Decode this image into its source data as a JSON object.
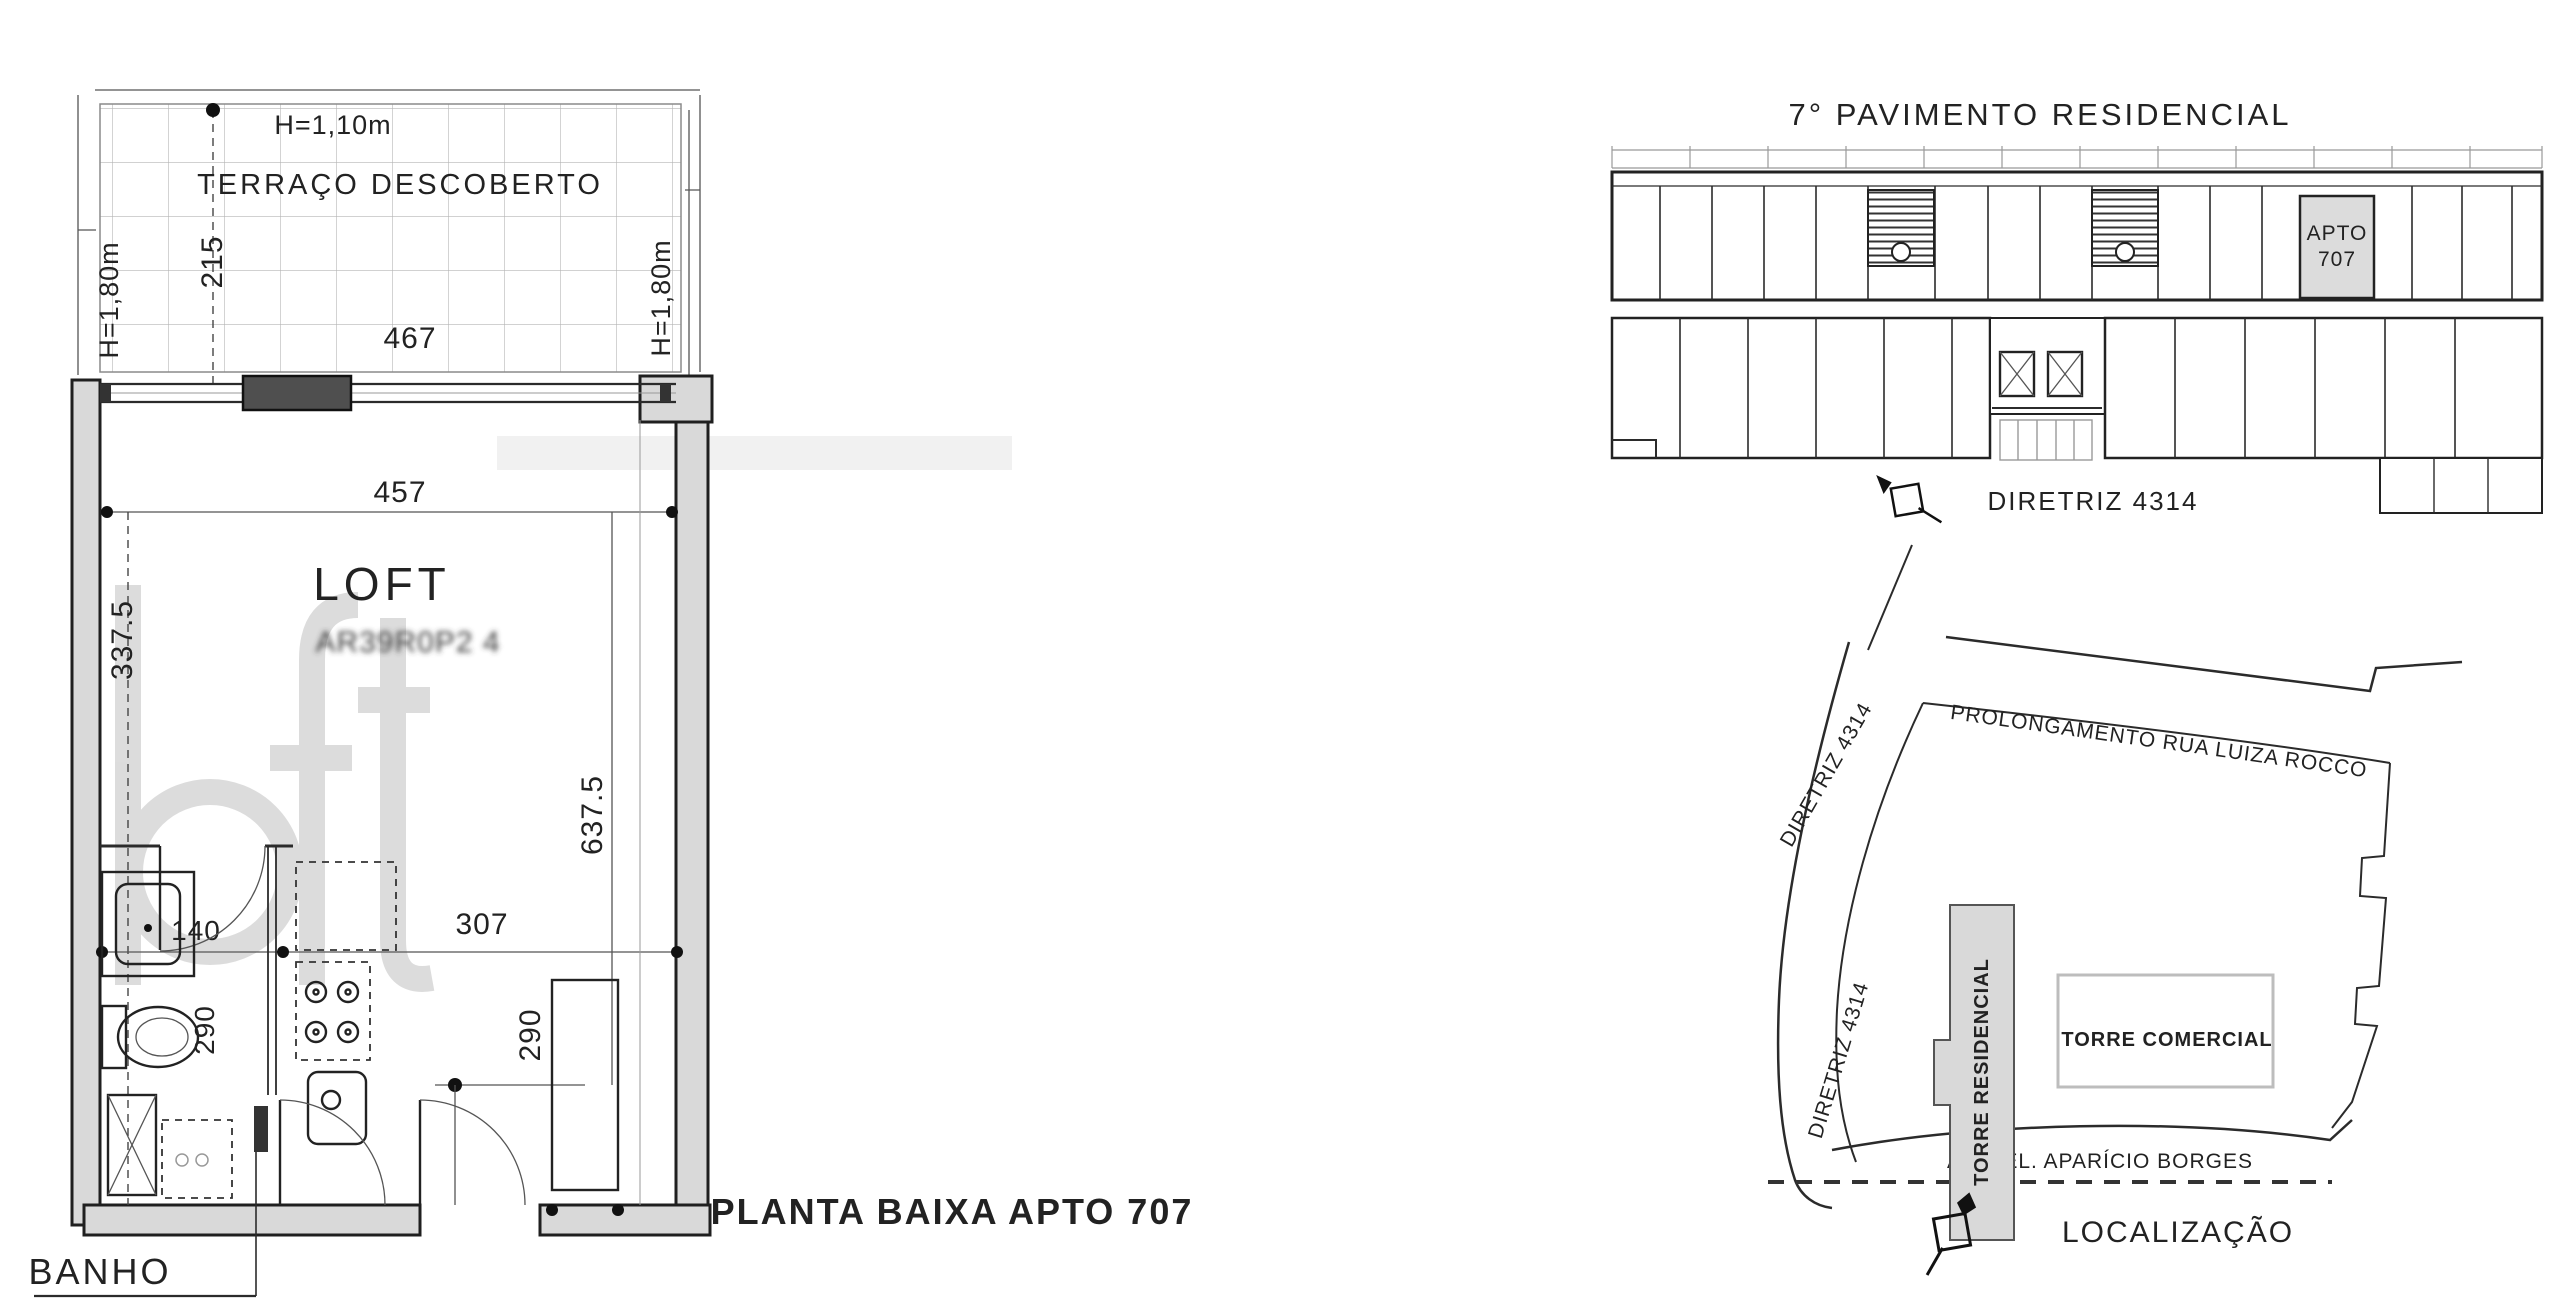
{
  "plan": {
    "caption": "PLANTA BAIXA APTO 707",
    "banho_label": "BANHO",
    "loft_label": "LOFT",
    "loft_area_blurred": "AR39R0P2 4",
    "terrace_label": "TERRAÇO DESCOBERTO",
    "h_parapet": "H=1,10m",
    "h_left": "H=1,80m",
    "h_right": "H=1,80m",
    "dim_215": "215",
    "dim_467": "467",
    "dim_457": "457",
    "dim_337": "337.5",
    "dim_637": "637.5",
    "dim_140": "140",
    "dim_307": "307",
    "dim_290_bath": "290",
    "dim_290_hall": "290"
  },
  "floor_diagram": {
    "title": "7° PAVIMENTO RESIDENCIAL",
    "apto_line1": "APTO",
    "apto_line2": "707",
    "diretriz": "DIRETRIZ 4314"
  },
  "map": {
    "street_top": "PROLONGAMENTO RUA LUIZA ROCCO",
    "diretriz_upper": "DIRETRIZ 4314",
    "diretriz_lower": "DIRETRIZ 4314",
    "tower_residential": "TORRE RESIDENCIAL",
    "tower_commercial": "TORRE COMERCIAL",
    "avenue": "AV. CEL. APARÍCIO BORGES",
    "title": "LOCALIZAÇÃO"
  },
  "watermark": "loft",
  "colors": {
    "line": "#2b2b2b",
    "wall_fill": "#d9d9d9",
    "unit_highlight": "#dcdcdc",
    "watermark": "#d4d4d4"
  }
}
